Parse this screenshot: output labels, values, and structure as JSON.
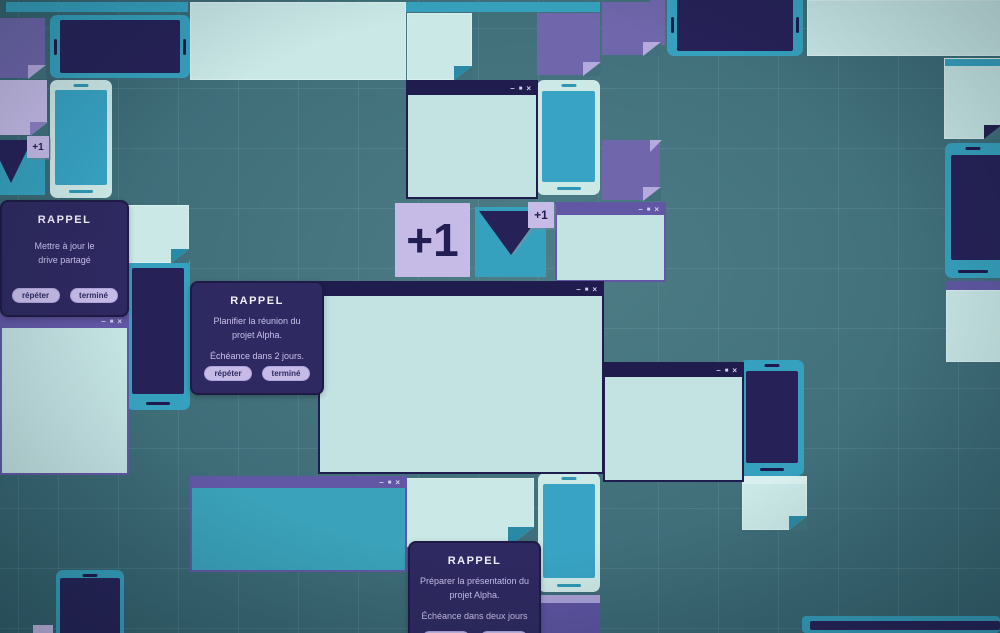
{
  "window_controls": {
    "minimize": "–",
    "maximize": "■",
    "close": "×"
  },
  "badge": {
    "label": "+1"
  },
  "cards": {
    "left": {
      "title": "RAPPEL",
      "line1": "Mettre à jour le",
      "line2": "drive partagé",
      "line3": "",
      "button_repeat": "répéter",
      "button_done": "terminé"
    },
    "center": {
      "title": "RAPPEL",
      "line1": "Planifier la réunion du",
      "line2": "projet Alpha.",
      "line3": "Échéance dans 2 jours.",
      "button_repeat": "répéter",
      "button_done": "terminé"
    },
    "bottom": {
      "title": "RAPPEL",
      "line1": "Préparer la présentation du",
      "line2": "projet Alpha.",
      "line3": "Échéance dans deux jours",
      "button_repeat": "répéter",
      "button_done": "terminé"
    }
  },
  "colors": {
    "teal": "#36a1be",
    "navy": "#262157",
    "titlebar_navy": "#211c4e",
    "titlebar_purple": "#6257a5",
    "mint": "#c9e8e6",
    "lavender": "#c6bbe7",
    "purple": "#6f66ab",
    "card_background": "#2e2960"
  }
}
